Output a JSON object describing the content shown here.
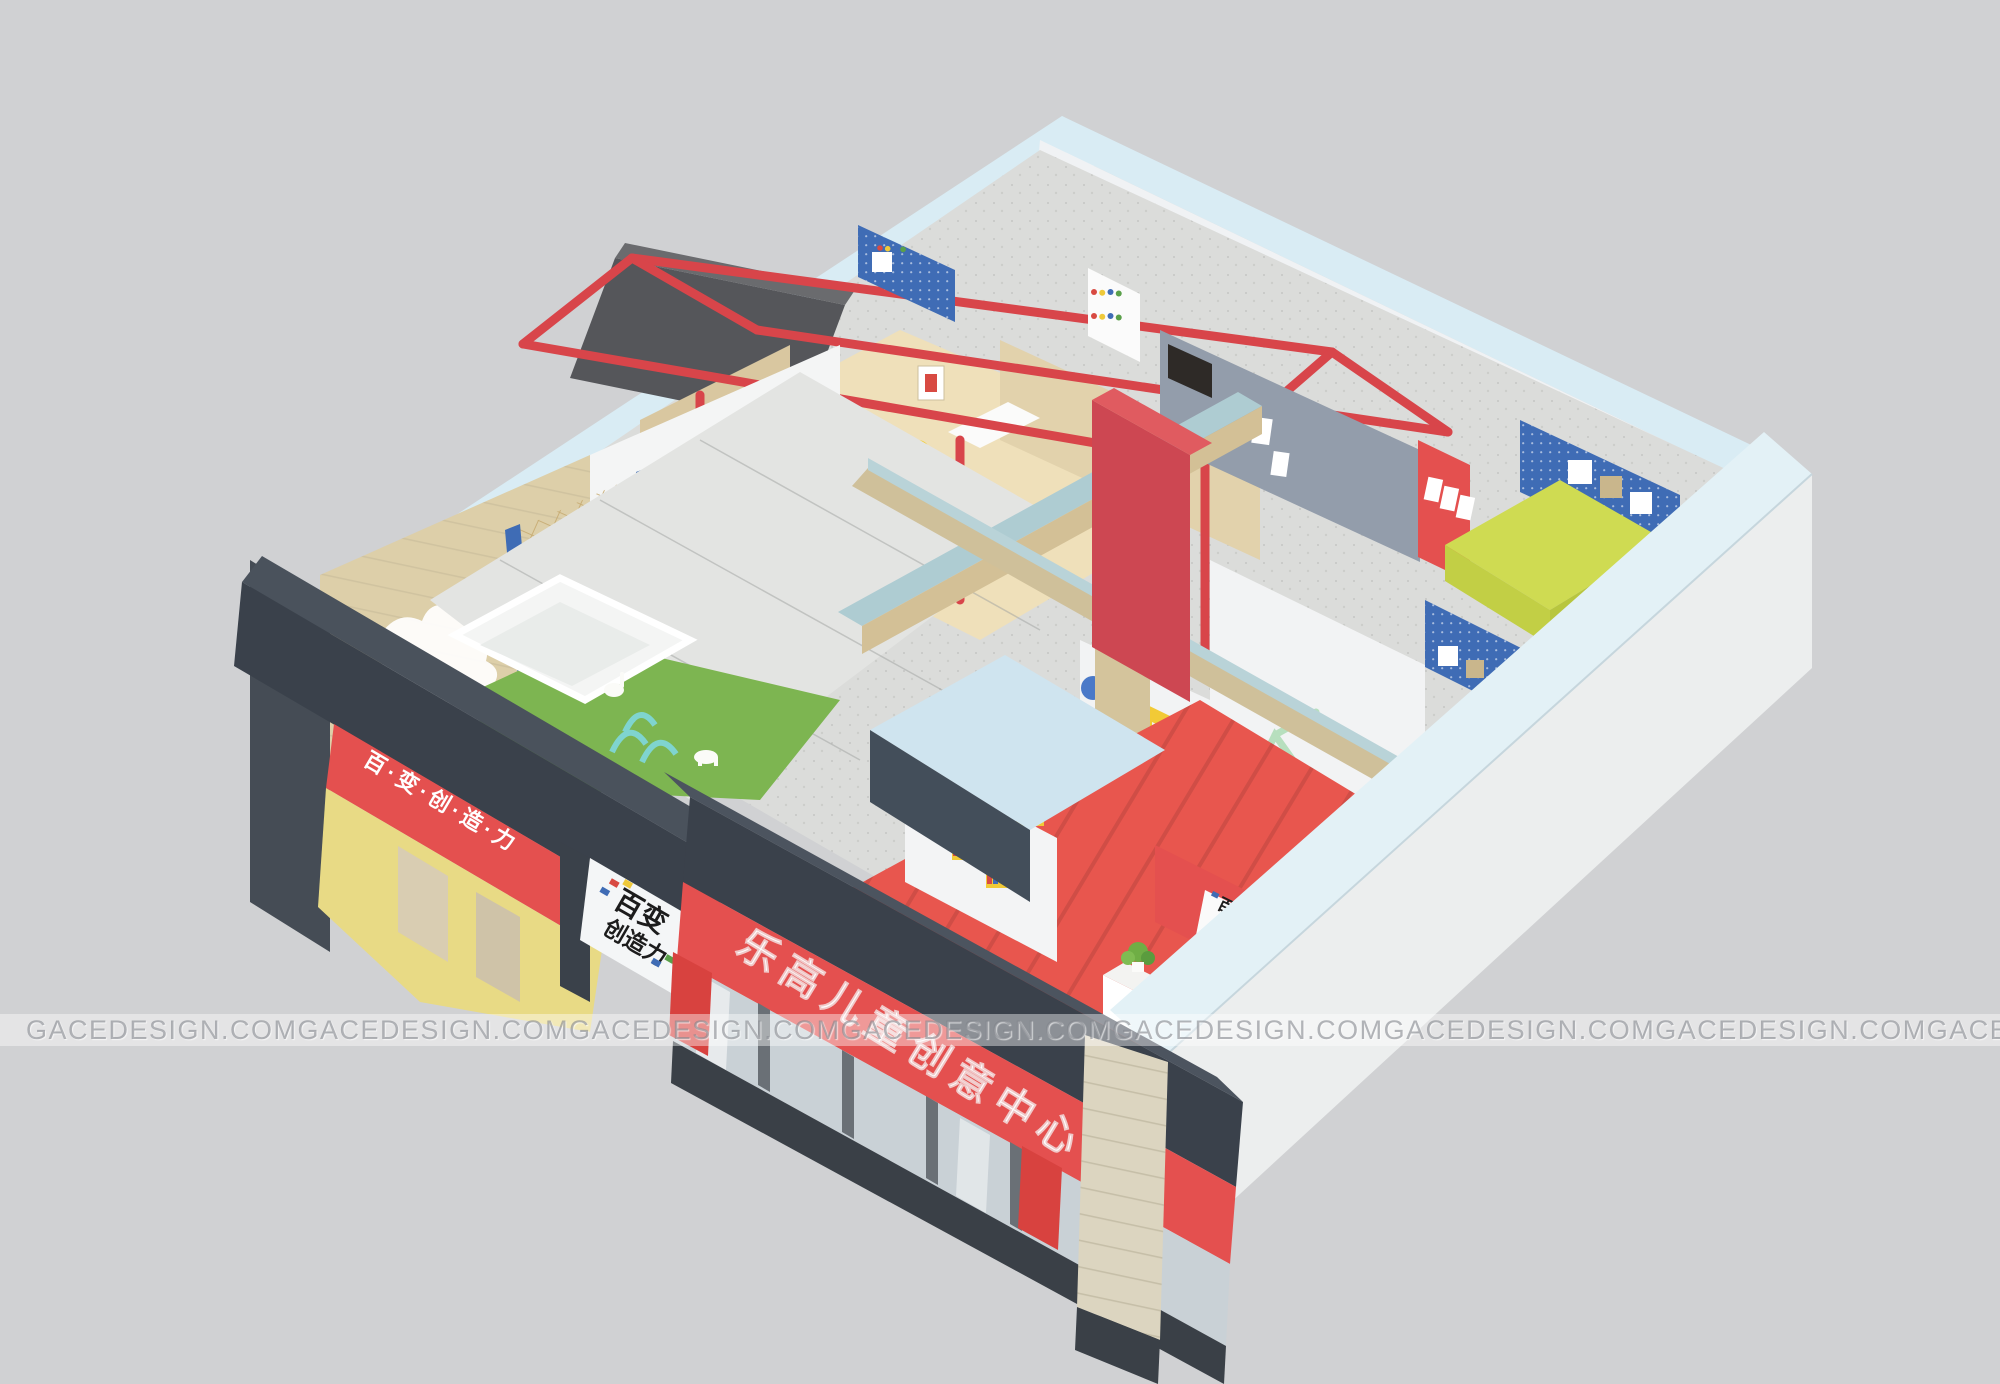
{
  "watermark": {
    "text": "GACEDESIGN.COM",
    "instances": 8
  },
  "storefront": {
    "main_sign_text": "乐高儿童创意中心",
    "side_sign_text": "百·变·创·造·力",
    "logo_board": {
      "line1": "百变",
      "line2": "创造力"
    }
  },
  "interior": {
    "reception_plaque": {
      "line1": "百变",
      "line2": "创造力"
    }
  },
  "colors": {
    "background": "#d0d1d3",
    "wall_cap_blue": "#d9ecf4",
    "awning_slate": "#3a414b",
    "sign_red": "#e4504f",
    "accent_red": "#d8454a",
    "facade_yellow": "#e8da85",
    "door_yellow": "#f2ca36",
    "pegboard_blue": "#3f6cb5",
    "lime_green": "#cfdb52",
    "turf_green": "#7db551",
    "wood": "#d9c7a0",
    "red_floor": "#e8564e",
    "mint_frame": "#b7dfbe",
    "watermark_text": "#9a9ea4"
  }
}
